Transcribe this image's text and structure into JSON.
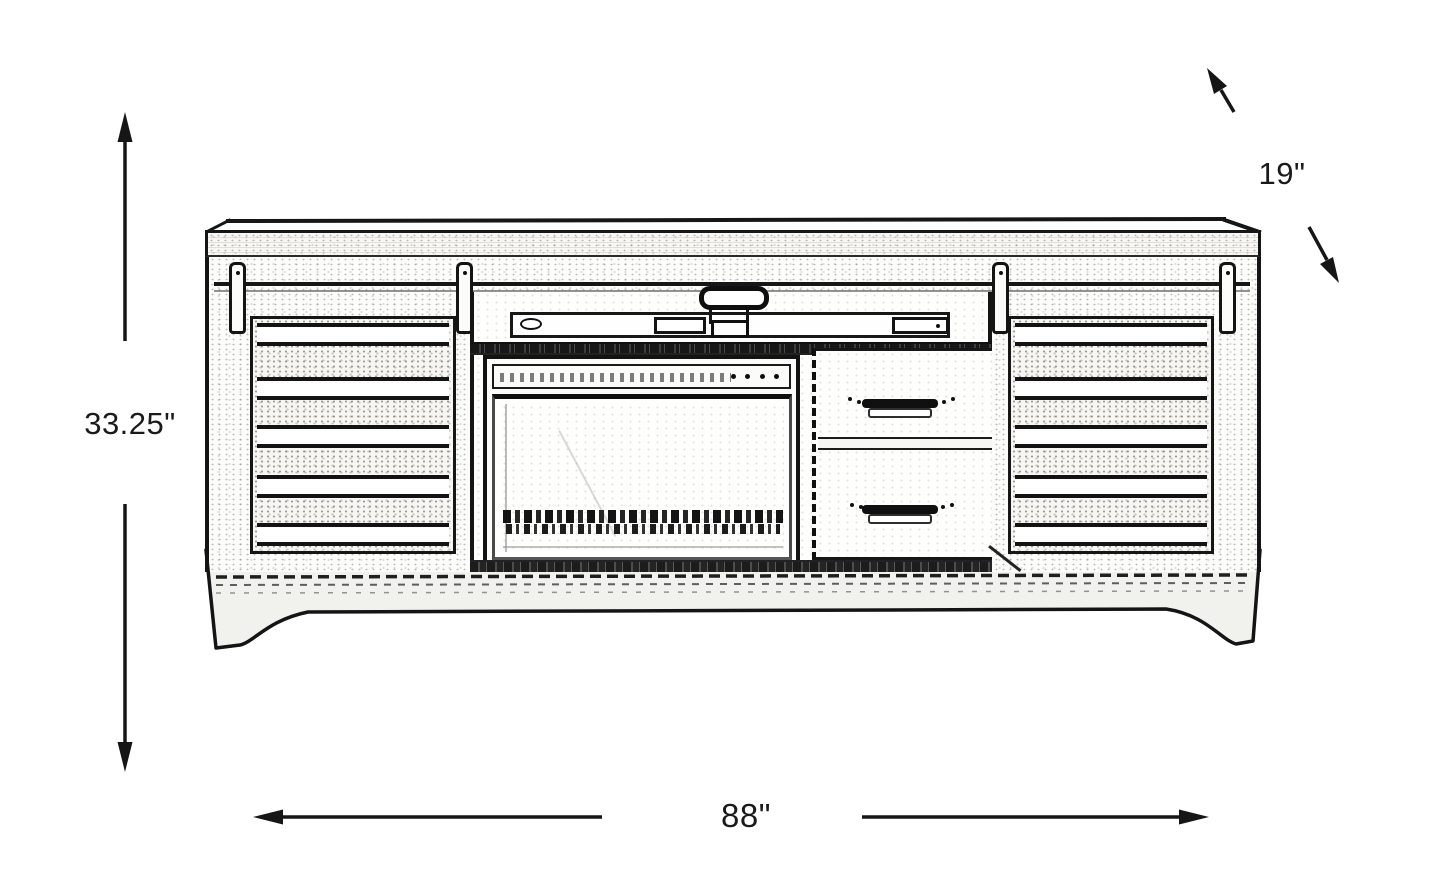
{
  "diagram": {
    "dimension_labels": {
      "height": "33.25\"",
      "width": "88\"",
      "depth": "19\""
    },
    "colors": {
      "ink": "#1a1a1a",
      "paper": "#ffffff"
    }
  }
}
